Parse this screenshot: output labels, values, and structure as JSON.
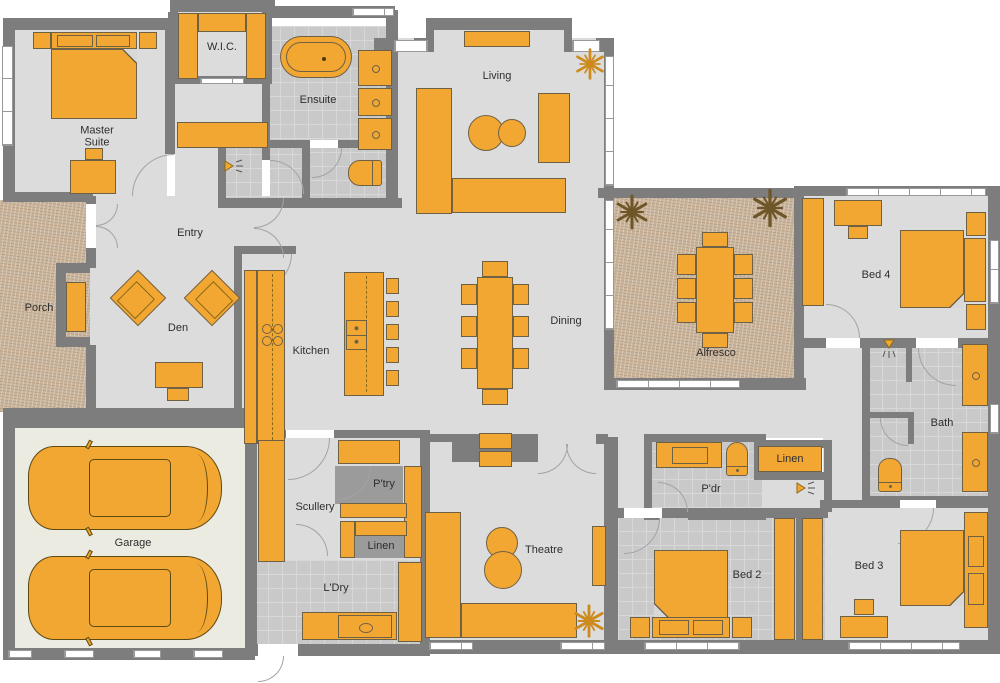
{
  "title": "House floor plan",
  "palette": {
    "wall": "#7d7d7d",
    "floor": "#dcdcdc",
    "tile_floor": "#c9c9c9",
    "dark_floor": "#9b9b9b",
    "outdoor_floor": "#cbb69d",
    "garage_floor": "#ebebe2",
    "furniture": "#f3a733",
    "furniture_outline": "#6f6145",
    "label_text": "#2e2e2e"
  },
  "rooms": {
    "master": "Master Suite",
    "wic": "W.I.C.",
    "ensuite": "Ensuite",
    "living": "Living",
    "entry": "Entry",
    "porch": "Porch",
    "den": "Den",
    "kitchen": "Kitchen",
    "dining": "Dining",
    "alfresco": "Alfresco",
    "bed4": "Bed 4",
    "bath": "Bath",
    "pdr": "P'dr",
    "linen_hall": "Linen",
    "scullery": "Scullery",
    "pantry": "P'try",
    "linen_scullery": "Linen",
    "laundry": "L'Dry",
    "theatre": "Theatre",
    "bed2": "Bed 2",
    "bed3": "Bed 3",
    "garage": "Garage"
  }
}
